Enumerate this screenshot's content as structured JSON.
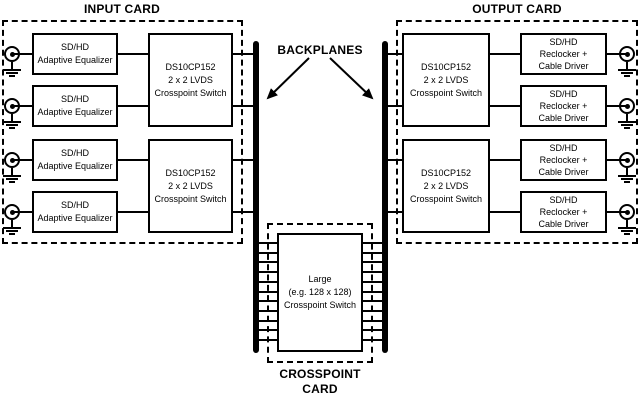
{
  "colors": {
    "ink": "#000000",
    "paper": "#ffffff"
  },
  "input_card": {
    "title": "INPUT CARD",
    "equalizers": [
      {
        "lines": [
          "SD/HD",
          "Adaptive Equalizer"
        ]
      },
      {
        "lines": [
          "SD/HD",
          "Adaptive Equalizer"
        ]
      },
      {
        "lines": [
          "SD/HD",
          "Adaptive Equalizer"
        ]
      },
      {
        "lines": [
          "SD/HD",
          "Adaptive Equalizer"
        ]
      }
    ],
    "switches": [
      {
        "lines": [
          "DS10CP152",
          "2 x 2 LVDS",
          "Crosspoint Switch"
        ]
      },
      {
        "lines": [
          "DS10CP152",
          "2 x 2 LVDS",
          "Crosspoint Switch"
        ]
      }
    ]
  },
  "backplanes": {
    "label": "BACKPLANES"
  },
  "output_card": {
    "title": "OUTPUT CARD",
    "switches": [
      {
        "lines": [
          "DS10CP152",
          "2 x 2 LVDS",
          "Crosspoint Switch"
        ]
      },
      {
        "lines": [
          "DS10CP152",
          "2 x 2 LVDS",
          "Crosspoint Switch"
        ]
      }
    ],
    "reclockers": [
      {
        "lines": [
          "SD/HD",
          "Reclocker +",
          "Cable Driver"
        ]
      },
      {
        "lines": [
          "SD/HD",
          "Reclocker +",
          "Cable Driver"
        ]
      },
      {
        "lines": [
          "SD/HD",
          "Reclocker +",
          "Cable Driver"
        ]
      },
      {
        "lines": [
          "SD/HD",
          "Reclocker +",
          "Cable Driver"
        ]
      }
    ]
  },
  "crosspoint_card": {
    "label_lines": [
      "CROSSPOINT",
      "CARD"
    ],
    "switch": {
      "lines": [
        "Large",
        "(e.g. 128 x 128)",
        "Crosspoint Switch"
      ]
    }
  }
}
